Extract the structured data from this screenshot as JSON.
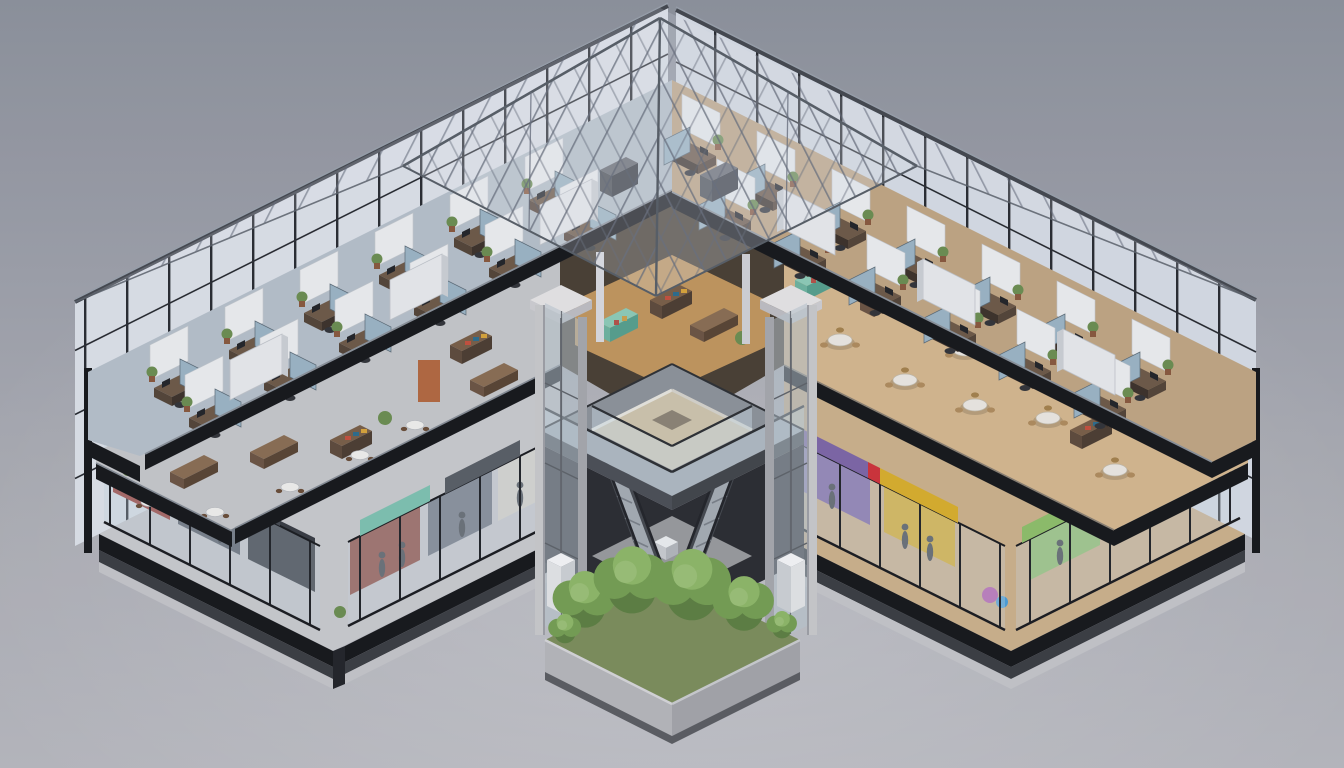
{
  "scene": {
    "type": "isometric-architectural-cutaway-render",
    "subject": "four-level mixed-use building with glass space-frame pyramid roof, cutaway front quarter exposing interiors",
    "view": "aerial isometric"
  },
  "background": {
    "top": "#8e939e",
    "bottom": "#b9bac0"
  },
  "structure": {
    "slab": "#17191d",
    "slab_fascia": "#3c3f44",
    "slab_base": "#c5c6ca",
    "mullion": "#2a2d33",
    "glass_wall": "#dde2ea",
    "roof_steel": "#6b7280",
    "roof_glass": "rgba(230,236,243,0.26)",
    "concrete": "#b7b8bc",
    "concrete_dark": "#8f9196"
  },
  "left_wing": {
    "floors": [
      {
        "name": "open-plan-office",
        "floor_color": "#b7c1cb",
        "furniture": [
          "desks",
          "privacy-screens",
          "white-partitions",
          "potted-plants",
          "monitors"
        ]
      },
      {
        "name": "cafe-bookstore",
        "floor_color": "#c6c8cb",
        "furniture": [
          "counters",
          "bookshelves",
          "round-tables"
        ]
      },
      {
        "name": "boutique-retail",
        "floor_color": "#c9cbcf",
        "furniture": [
          "glass-storefronts",
          "mannequins",
          "clothing-racks"
        ]
      }
    ]
  },
  "right_wing": {
    "floors": [
      {
        "name": "open-plan-office",
        "floor_color": "#c1a785",
        "furniture": [
          "desks",
          "privacy-screens",
          "white-partitions",
          "potted-plants",
          "monitors"
        ]
      },
      {
        "name": "food-court",
        "floor_color": "#d6b990",
        "furniture": [
          "round-tables",
          "wood-chairs",
          "display-shelves",
          "counters"
        ]
      },
      {
        "name": "retail-shops",
        "floor_color": "#cdb28d",
        "furniture": [
          "glass-storefronts",
          "mannequins"
        ]
      }
    ]
  },
  "atrium": {
    "features": [
      "walkway-ring-with-glass-railings",
      "bridge",
      "glass-elevator-left",
      "glass-elevator-right",
      "crossing-escalators",
      "sunken-plaza",
      "tree-planter",
      "mezzanine-stalls"
    ],
    "walkway_deck": "#8e949c",
    "void": "#2c2e33"
  },
  "storefront_accents": {
    "purple": "#7e68a8",
    "yellow": "#d9af2e",
    "red": "#d0353c",
    "green": "#8fc06c",
    "teal": "#7fc3b2",
    "maroon": "#8e4a40",
    "slate": "#5a6068"
  },
  "office_furniture_colors": {
    "desk": "#6f5b49",
    "privacy_screen": "#9db6c6",
    "partition": "#edeff1"
  },
  "vegetation": {
    "tree_greens": [
      "#5e8044",
      "#76a055",
      "#8fb96a"
    ],
    "trunk": "#5a4632"
  }
}
